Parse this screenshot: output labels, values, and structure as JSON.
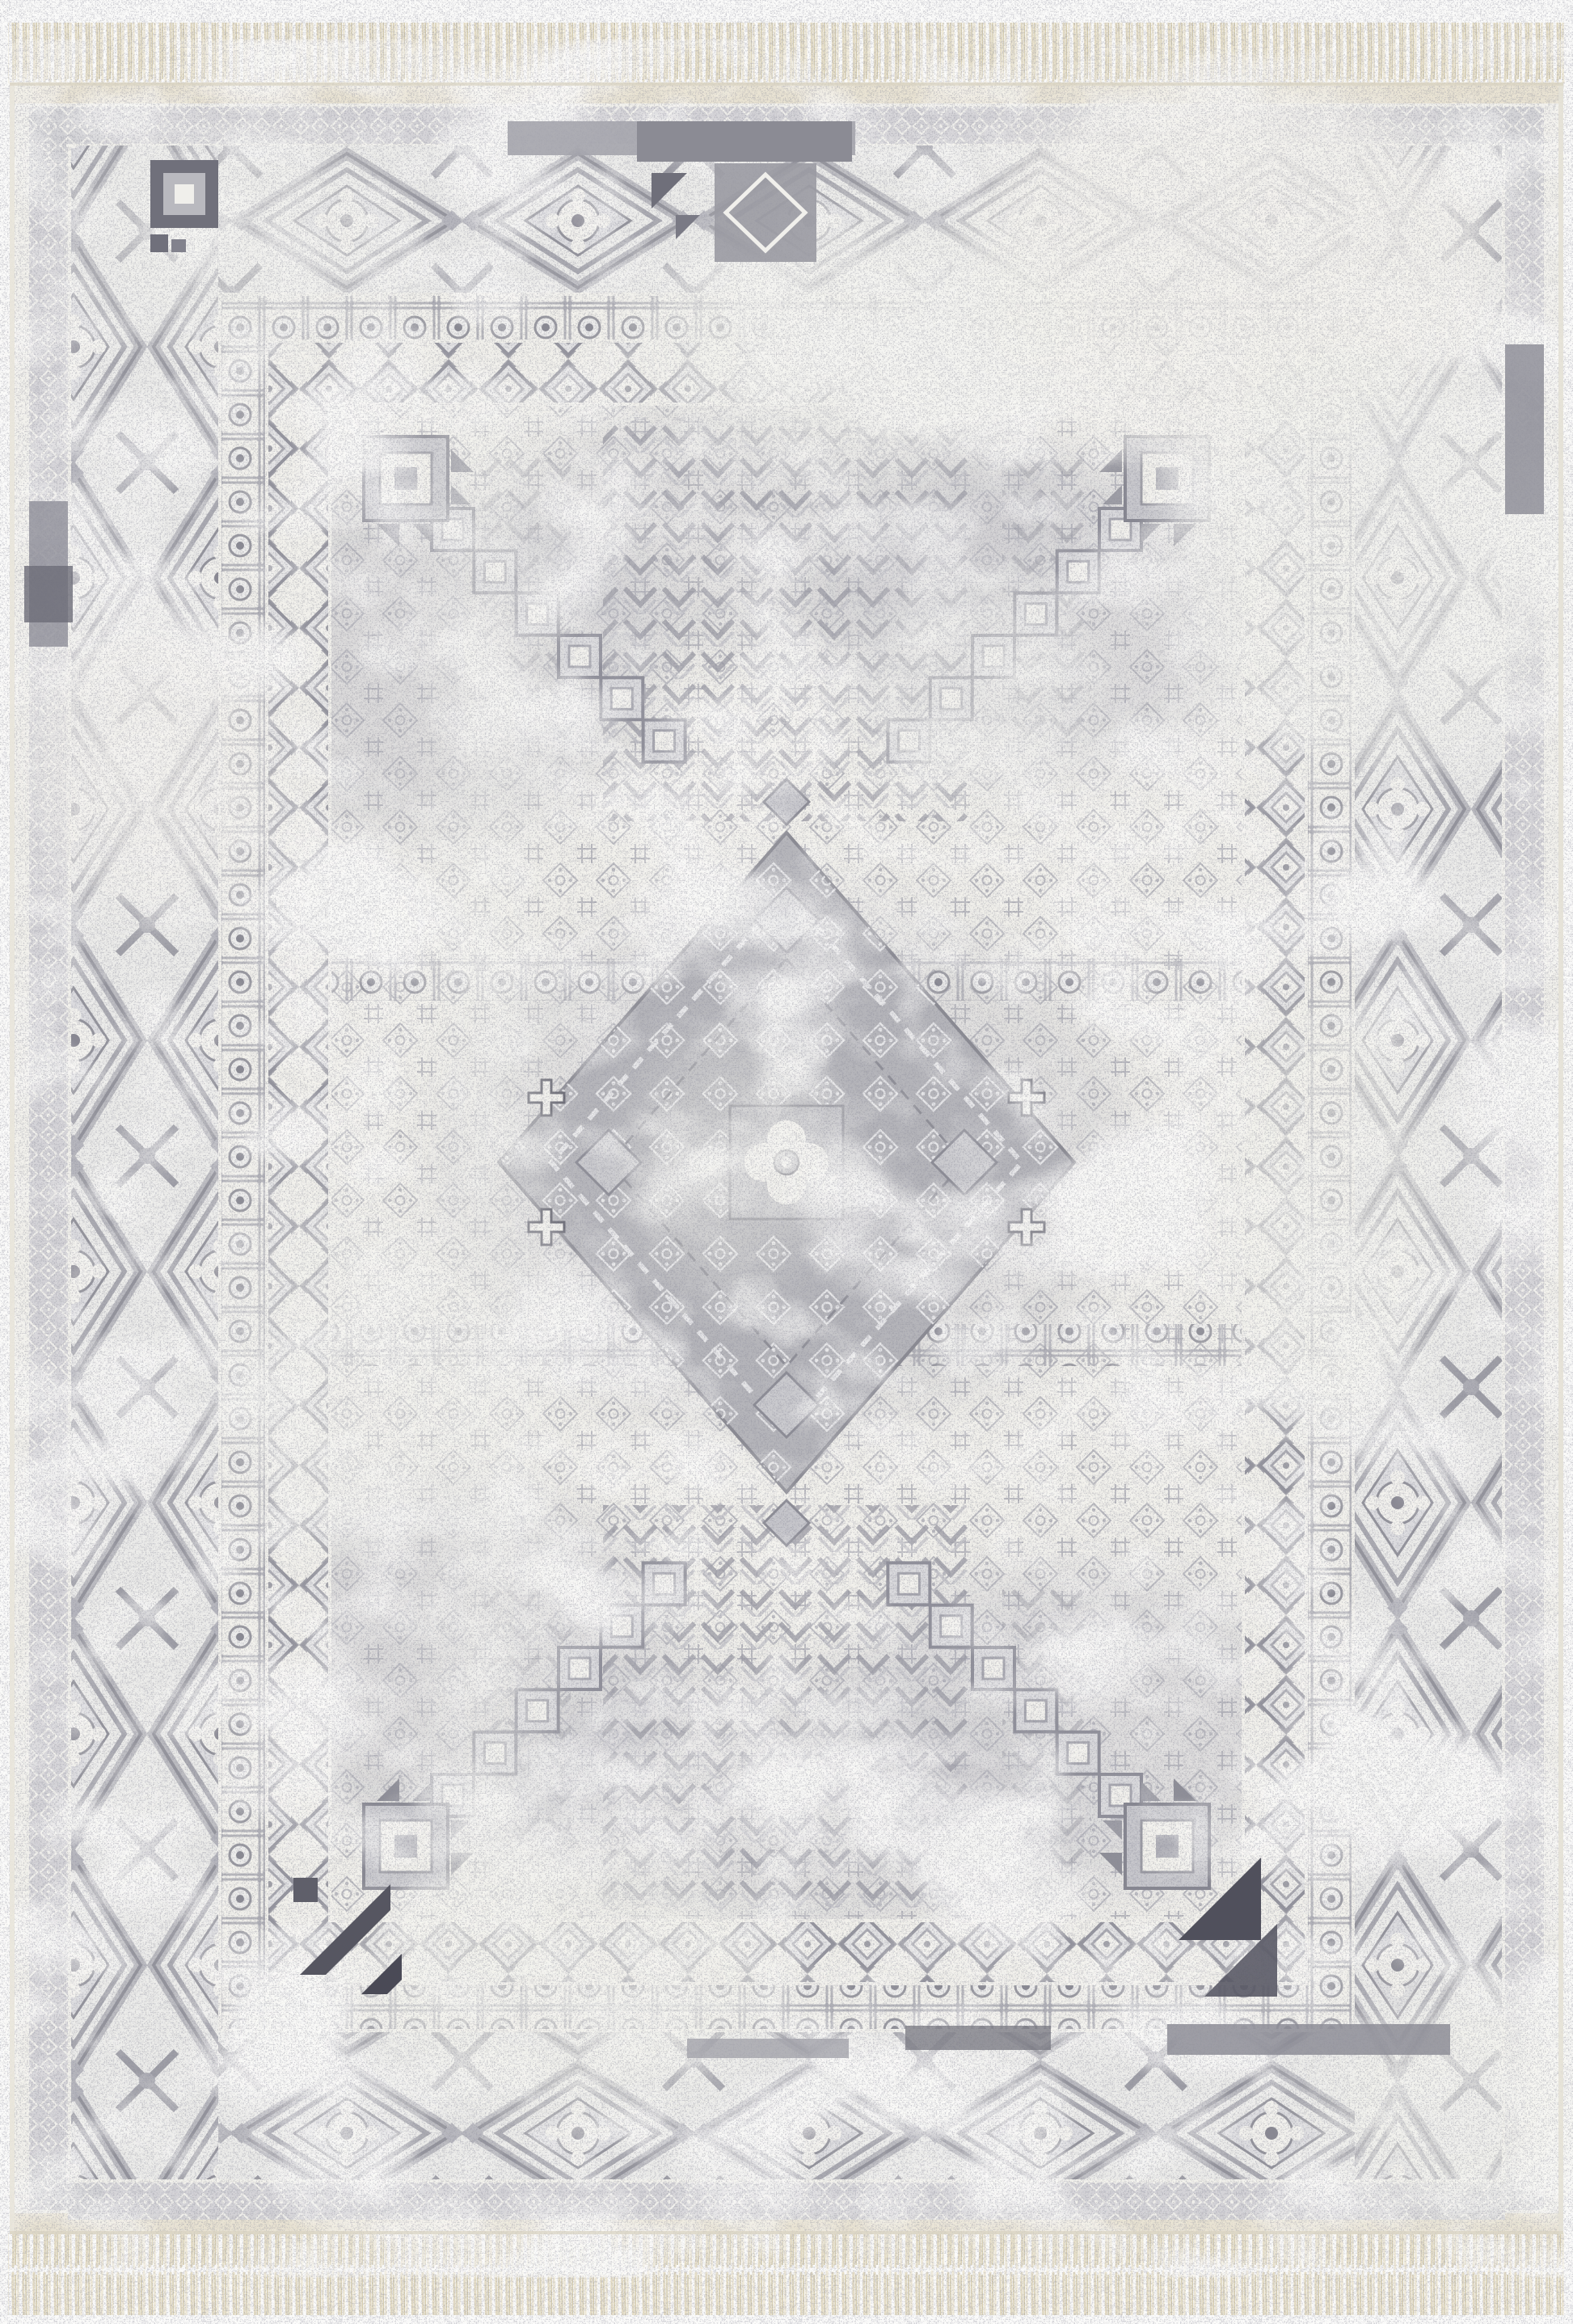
{
  "image": {
    "type": "product-photograph",
    "subject": "distressed traditional oriental area rug",
    "style": "heriz-serapi geometric medallion, vintage washed finish",
    "orientation": "portrait",
    "features": [
      "cream fringe tassels at top and bottom edges",
      "outer small-diamond lattice border band",
      "wide main border with large concentric diamond medallions and X connectors",
      "rosette-in-square guard band",
      "diamond-chain inner border band",
      "field with four stepped corner blocks and diagonal diamond chains",
      "vertical chevron tree columns above and below center",
      "central stepped lozenge medallion with quatrefoil rosette",
      "heavy white distressed abrash patches",
      "dark gray accent blocks at corners and bars at top and bottom"
    ]
  },
  "palette": {
    "page_bg": "#fbfbfa",
    "ivory": "#f2f1ec",
    "kilim_cream": "#e9e3d3",
    "fringe_light": "#f0ead9",
    "fringe_mid": "#e5ddc6",
    "fringe_dark": "#d7ceb0",
    "lattice_bg": "#d2d2d6",
    "lattice_line": "#f1f0ec",
    "border_stroke": "#8f8f98",
    "border_light": "#b9b9bf",
    "guard_stroke": "#b0b0b7",
    "field_motif": "#b4b4bb",
    "chevron_gray": "#9f9fa8",
    "chain_fill": "#e3e3e4",
    "panel_gray": "#b5b5ba",
    "medallion_square": "#bcbcc1",
    "rosette_white": "#f2f1ed",
    "rosette_core": "#a9a9b0",
    "dark_accent": "#565661",
    "darkest": "#4a4a56",
    "gray_patch": "#b9b9c0",
    "wash_white": "#f4f3ef",
    "grain_dark": "#3f3f4a"
  }
}
